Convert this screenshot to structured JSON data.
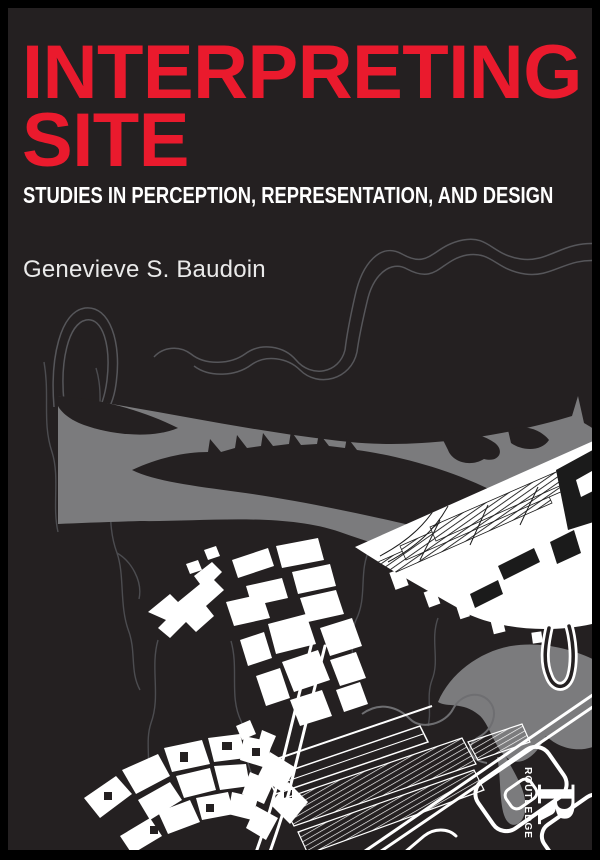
{
  "cover": {
    "title_line1": "INTERPRETING",
    "title_line2": "SITE",
    "subtitle": "STUDIES IN PERCEPTION, REPRESENTATION, AND DESIGN",
    "author": "Genevieve S. Baudoin",
    "publisher": {
      "name": "ROUTLEDGE",
      "monogram": "R"
    },
    "artwork": {
      "description_elements": [
        "contour-lines",
        "stream-lines",
        "river-shape",
        "map-wedge",
        "building-cluster-center",
        "building-cluster-bottom",
        "road-outlines",
        "hatched-blocks"
      ]
    },
    "colors": {
      "frame": "#000000",
      "background": "#242021",
      "title": "#ea1a2d",
      "subtitle": "#ffffff",
      "author": "#eaeaea",
      "river": "#7b7b7d",
      "contour": "#56565a",
      "map_white": "#ffffff"
    }
  }
}
